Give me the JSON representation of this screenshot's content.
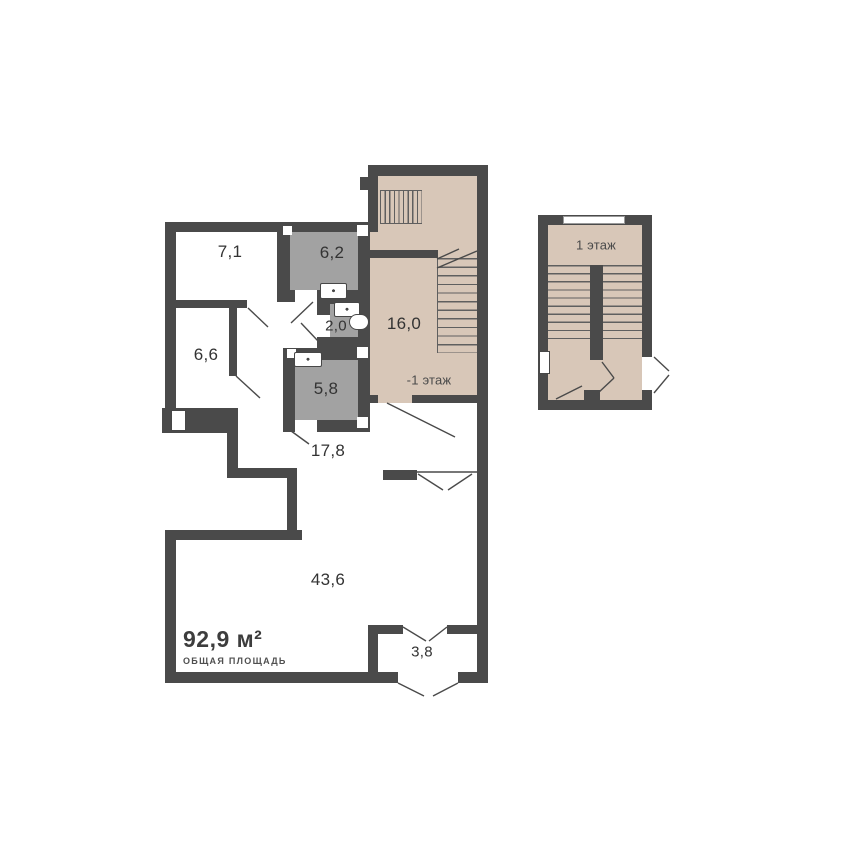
{
  "plan": {
    "type": "apartment-floor-plan",
    "total_area": {
      "value": "92,9 м²",
      "caption": "ОБЩАЯ ПЛОЩАДЬ"
    },
    "floor_notes": {
      "main": "-1 этаж",
      "secondary_title": "1 этаж"
    },
    "rooms": [
      {
        "name": "room-top-left",
        "area": "7,1"
      },
      {
        "name": "wet-room-upper",
        "area": "6,2"
      },
      {
        "name": "wc",
        "area": "2,0"
      },
      {
        "name": "room-left",
        "area": "6,6"
      },
      {
        "name": "wet-room-lower",
        "area": "5,8"
      },
      {
        "name": "stair-hall",
        "area": "16,0"
      },
      {
        "name": "corridor",
        "area": "17,8"
      },
      {
        "name": "living-room",
        "area": "43,6"
      },
      {
        "name": "balcony",
        "area": "3,8"
      }
    ]
  },
  "colors": {
    "wall": "#4a4a4a",
    "wet_room_fill": "#a2a2a2",
    "stair_zone_fill": "#d8c7b8",
    "label_text": "#333333"
  }
}
